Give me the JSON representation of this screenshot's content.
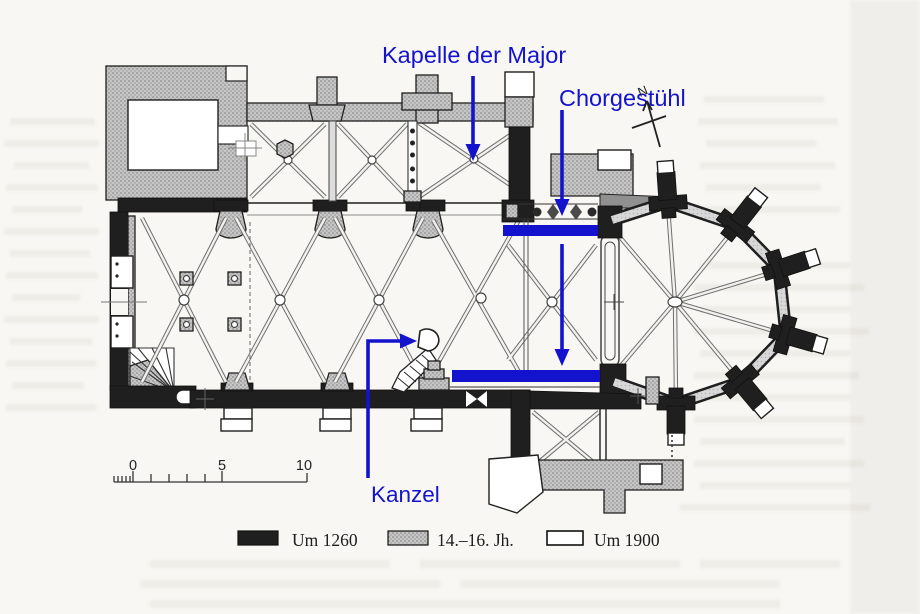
{
  "figure": {
    "type": "church-floor-plan-scan",
    "annotations": {
      "kapelle_label": "Kapelle der Major",
      "chorgestuehl_label": "Chorgestühl",
      "kanzel_label": "Kanzel"
    },
    "north_indicator": "N",
    "scale_bar": {
      "tick_0": "0",
      "tick_5": "5",
      "tick_10": "10"
    },
    "legend": {
      "items": [
        {
          "label": "Um 1260",
          "swatch": "black"
        },
        {
          "label": "14.–16. Jh.",
          "swatch": "gray"
        },
        {
          "label": "Um 1900",
          "swatch": "white"
        }
      ]
    },
    "colors": {
      "annotation_blue": "#1313cd",
      "wall_black": "#1f1f1f",
      "later_gray": "#c6c6c6",
      "paper": "#f8f7f3"
    }
  }
}
